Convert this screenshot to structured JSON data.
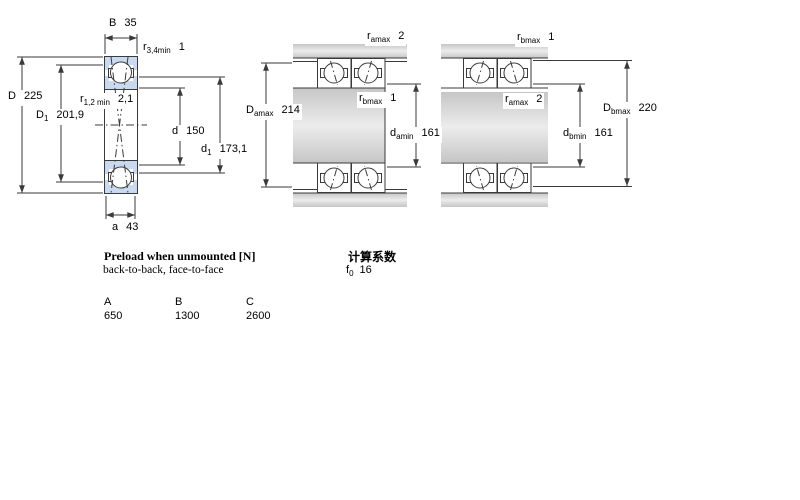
{
  "colors": {
    "line": "#3a3a3a",
    "ring_fill": "#c9d9ef",
    "metal_fill": "#d4d4d4",
    "background": "#ffffff"
  },
  "left_diagram": {
    "description_name": "single-bearing-cross-section",
    "dims": {
      "B": {
        "base": "B",
        "sub": "",
        "value": "35"
      },
      "r34": {
        "base": "r",
        "sub": "3,4min",
        "value": "1"
      },
      "D": {
        "base": "D",
        "sub": "",
        "value": "225"
      },
      "D1": {
        "base": "D",
        "sub": "1",
        "value": "201,9"
      },
      "r12": {
        "base": "r",
        "sub": "1,2 min",
        "value": "2,1"
      },
      "d": {
        "base": "d",
        "sub": "",
        "value": "150"
      },
      "d1": {
        "base": "d",
        "sub": "1",
        "value": "173,1"
      },
      "a": {
        "base": "a",
        "sub": "",
        "value": "43"
      }
    }
  },
  "middle_diagram": {
    "description_name": "paired-mounting-shaft-abutment",
    "dims": {
      "ra": {
        "base": "r",
        "sub": "amax",
        "value": "2"
      },
      "Da": {
        "base": "D",
        "sub": "amax",
        "value": "214"
      },
      "rb": {
        "base": "r",
        "sub": "bmax",
        "value": "1"
      },
      "da": {
        "base": "d",
        "sub": "amin",
        "value": "161"
      }
    }
  },
  "right_diagram": {
    "description_name": "paired-mounting-housing-abutment",
    "dims": {
      "rb": {
        "base": "r",
        "sub": "bmax",
        "value": "1"
      },
      "ra": {
        "base": "r",
        "sub": "amax",
        "value": "2"
      },
      "Db": {
        "base": "D",
        "sub": "bmax",
        "value": "220"
      },
      "db": {
        "base": "d",
        "sub": "bmin",
        "value": "161"
      }
    }
  },
  "preload": {
    "title": "Preload when unmounted [N]",
    "subtitle": "back-to-back, face-to-face",
    "columns": [
      "A",
      "B",
      "C"
    ],
    "values": [
      "650",
      "1300",
      "2600"
    ]
  },
  "calculation": {
    "title": "计算系数",
    "factor": {
      "base": "f",
      "sub": "0",
      "value": "16"
    }
  }
}
